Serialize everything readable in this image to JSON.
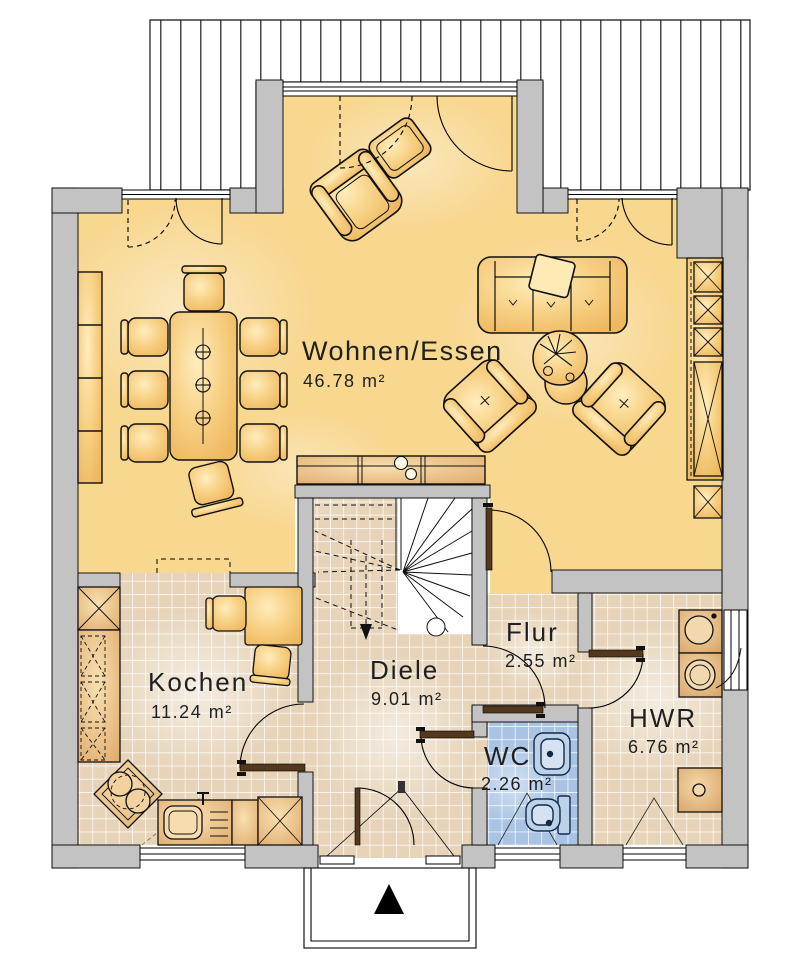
{
  "page": {
    "type": "floor-plan",
    "background": "#ffffff"
  },
  "rooms": [
    {
      "name": "Wohnen/Essen",
      "area": "46.78 m²"
    },
    {
      "name": "Kochen",
      "area": "11.24 m²"
    },
    {
      "name": "Diele",
      "area": "9.01 m²"
    },
    {
      "name": "Flur",
      "area": "2.55 m²"
    },
    {
      "name": "WC",
      "area": "2.26 m²"
    },
    {
      "name": "HWR",
      "area": "6.76 m²"
    }
  ],
  "colors": {
    "living_floor": "#f8d78f",
    "tile_floor": "#e6d3b8",
    "wc_floor": "#a8c3e3",
    "wall": "#c3c3c3",
    "furniture": "#f5c878",
    "door_leaf": "#53381c",
    "text": "#1f1f1f"
  },
  "icons": {
    "entrance_arrow": "triangle-up"
  }
}
